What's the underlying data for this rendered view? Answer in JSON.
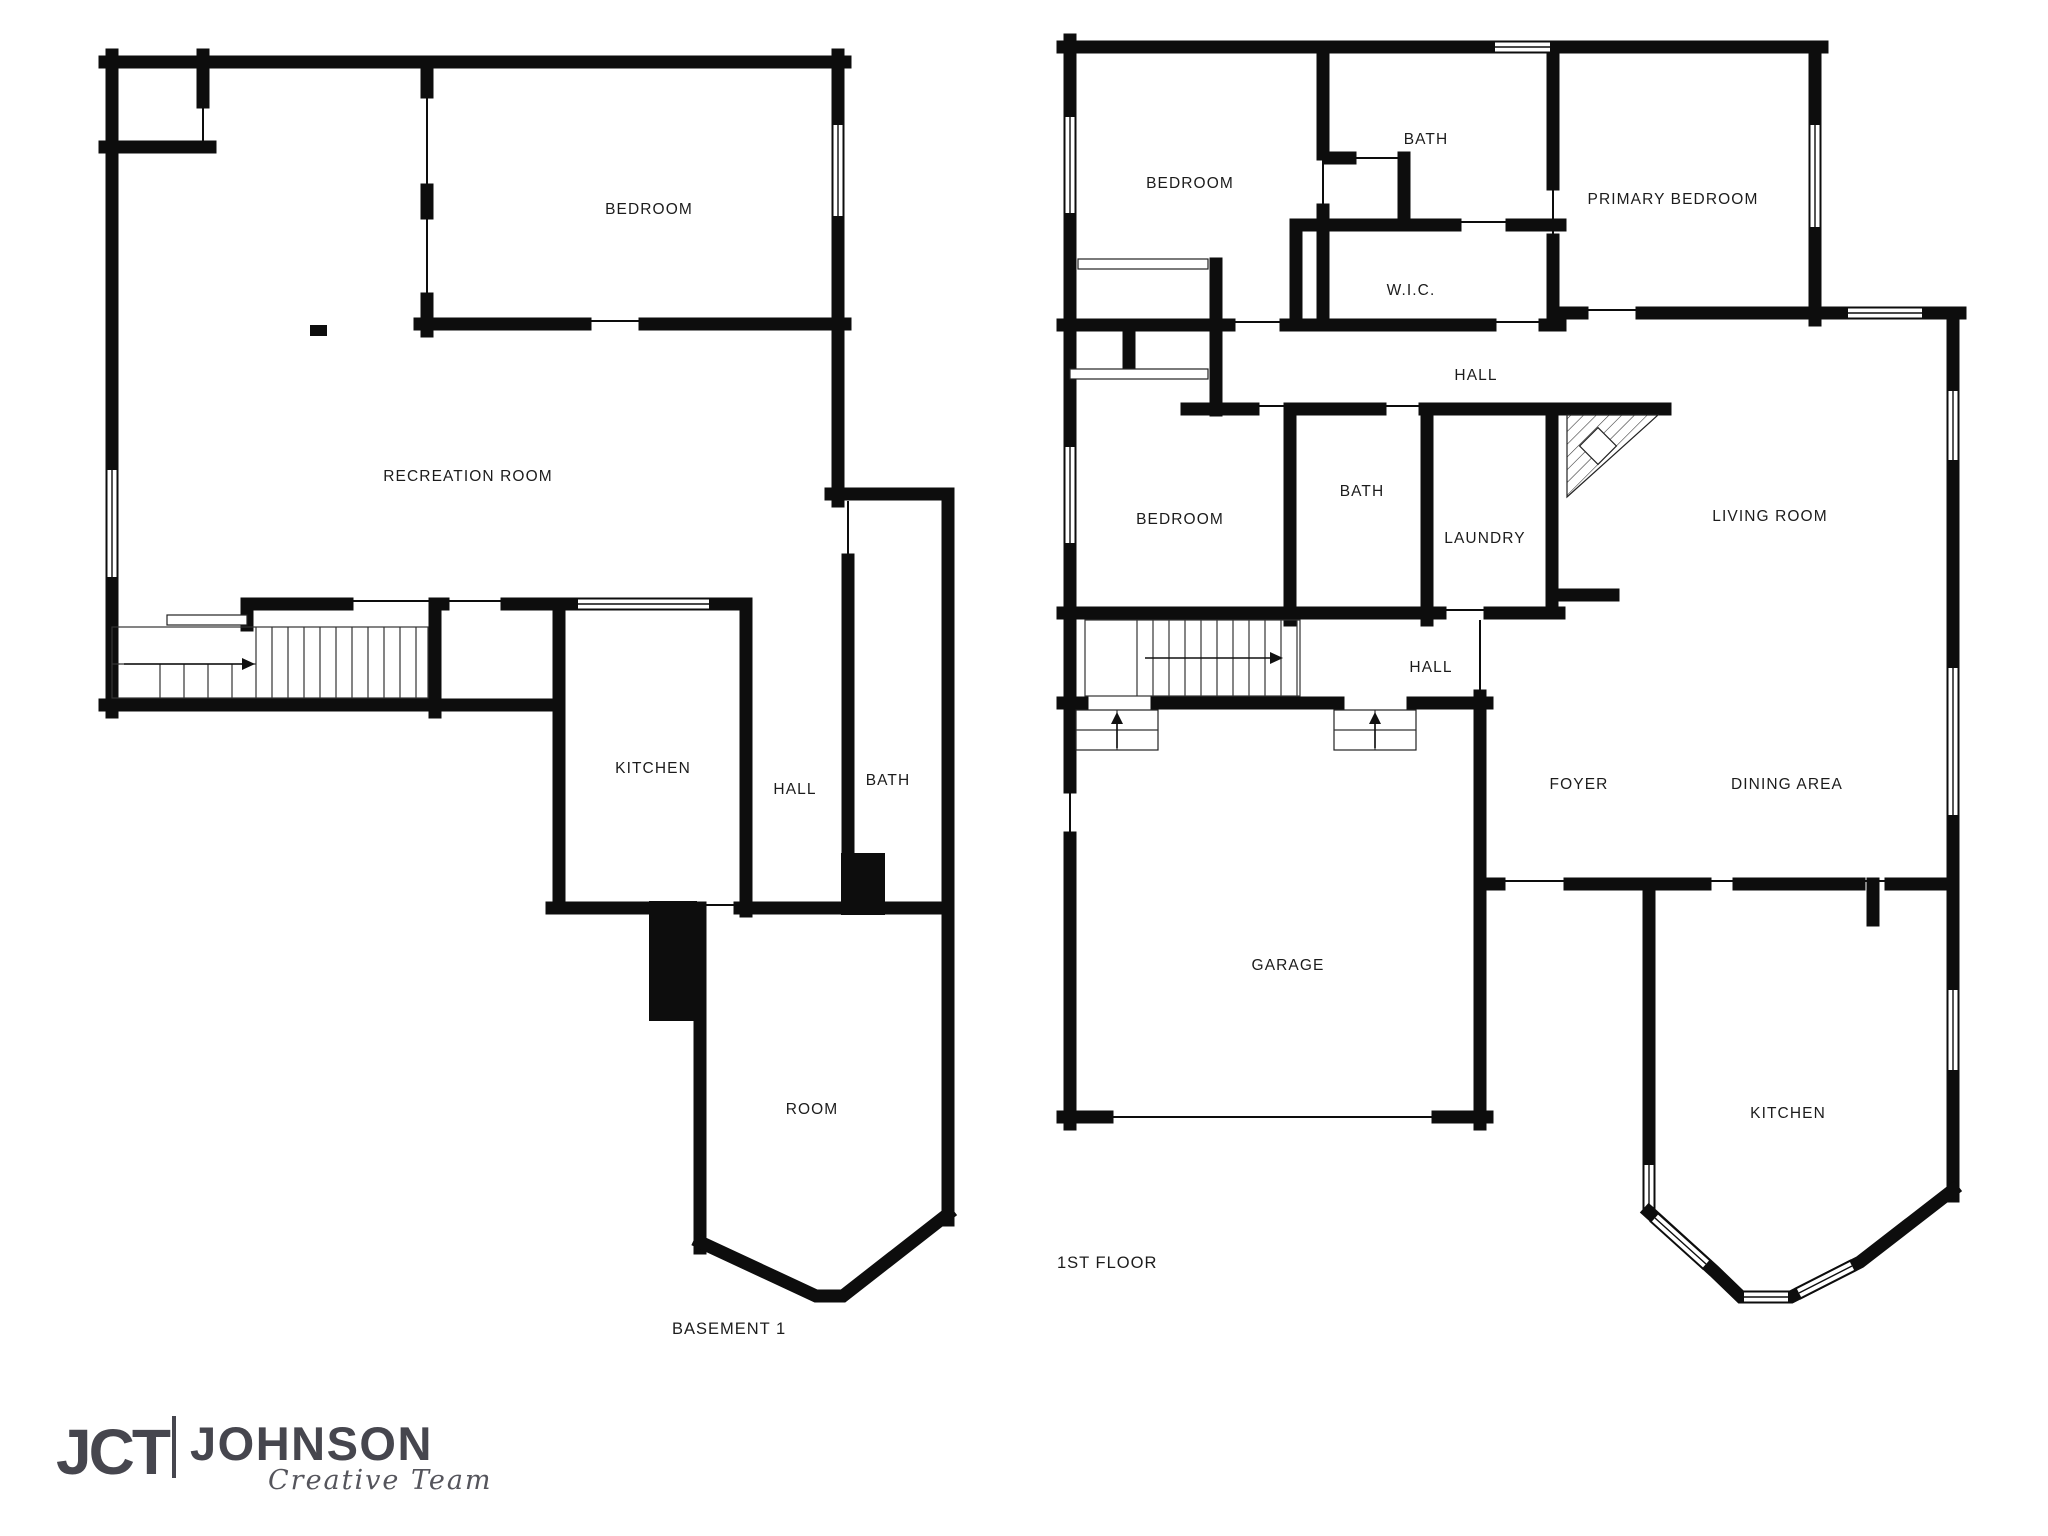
{
  "page": {
    "background": "#ffffff"
  },
  "colors": {
    "walls": "#0d0d0d",
    "labels": "#1c1c1c",
    "logo": "#46464e",
    "window_fill": "#ffffff"
  },
  "floor_plans": [
    {
      "id": "basement",
      "caption": "BASEMENT 1",
      "rooms": [
        {
          "name": "BEDROOM",
          "x": 649,
          "y": 214
        },
        {
          "name": "RECREATION ROOM",
          "x": 468,
          "y": 481
        },
        {
          "name": "KITCHEN",
          "x": 653,
          "y": 773
        },
        {
          "name": "HALL",
          "x": 795,
          "y": 794
        },
        {
          "name": "BATH",
          "x": 888,
          "y": 785
        },
        {
          "name": "ROOM",
          "x": 812,
          "y": 1114
        }
      ]
    },
    {
      "id": "first-floor",
      "caption": "1ST FLOOR",
      "rooms": [
        {
          "name": "BEDROOM",
          "x": 1190,
          "y": 188
        },
        {
          "name": "BATH",
          "x": 1426,
          "y": 144
        },
        {
          "name": "PRIMARY BEDROOM",
          "x": 1673,
          "y": 204
        },
        {
          "name": "W.I.C.",
          "x": 1411,
          "y": 295
        },
        {
          "name": "HALL",
          "x": 1476,
          "y": 380
        },
        {
          "name": "BEDROOM",
          "x": 1180,
          "y": 524
        },
        {
          "name": "BATH",
          "x": 1362,
          "y": 496
        },
        {
          "name": "LAUNDRY",
          "x": 1485,
          "y": 543
        },
        {
          "name": "LIVING ROOM",
          "x": 1770,
          "y": 521
        },
        {
          "name": "HALL",
          "x": 1431,
          "y": 672
        },
        {
          "name": "FOYER",
          "x": 1579,
          "y": 789
        },
        {
          "name": "DINING AREA",
          "x": 1787,
          "y": 789
        },
        {
          "name": "GARAGE",
          "x": 1288,
          "y": 970
        },
        {
          "name": "KITCHEN",
          "x": 1788,
          "y": 1118
        }
      ]
    }
  ],
  "logo": {
    "mark": "JCT",
    "name": "JOHNSON",
    "tagline": "Creative Team"
  }
}
